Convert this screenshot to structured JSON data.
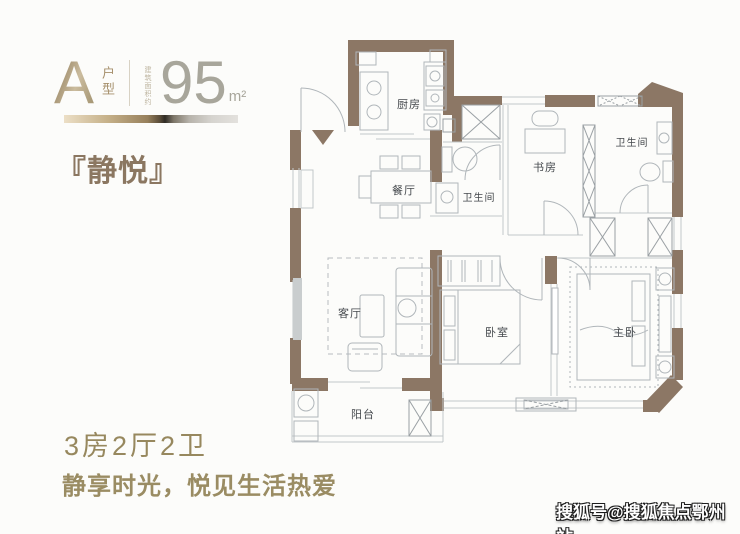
{
  "header": {
    "unit_letter": "A",
    "unit_type_label": "户型",
    "area_note": "建筑面积约",
    "area_value": "95",
    "area_unit": "m²",
    "plan_name": "『静悦』"
  },
  "plan": {
    "rooms": [
      {
        "id": "kitchen",
        "label": "厨房"
      },
      {
        "id": "dining",
        "label": "餐厅"
      },
      {
        "id": "bath-middle",
        "label": "卫生间"
      },
      {
        "id": "study",
        "label": "书房"
      },
      {
        "id": "bath-top-right",
        "label": "卫生间"
      },
      {
        "id": "living",
        "label": "客厅"
      },
      {
        "id": "bedroom",
        "label": "卧室"
      },
      {
        "id": "master-bedroom",
        "label": "主卧"
      },
      {
        "id": "balcony",
        "label": "阳台"
      }
    ],
    "colors": {
      "wall": "#8c7765",
      "furniture_line": "#b0b6ba",
      "label": "#45494d"
    }
  },
  "footer": {
    "layout_summary": "3房2厅2卫",
    "tagline": "静享时光，悦见生活热爱"
  },
  "watermark": {
    "text": "搜狐号@搜狐焦点鄂州站"
  }
}
